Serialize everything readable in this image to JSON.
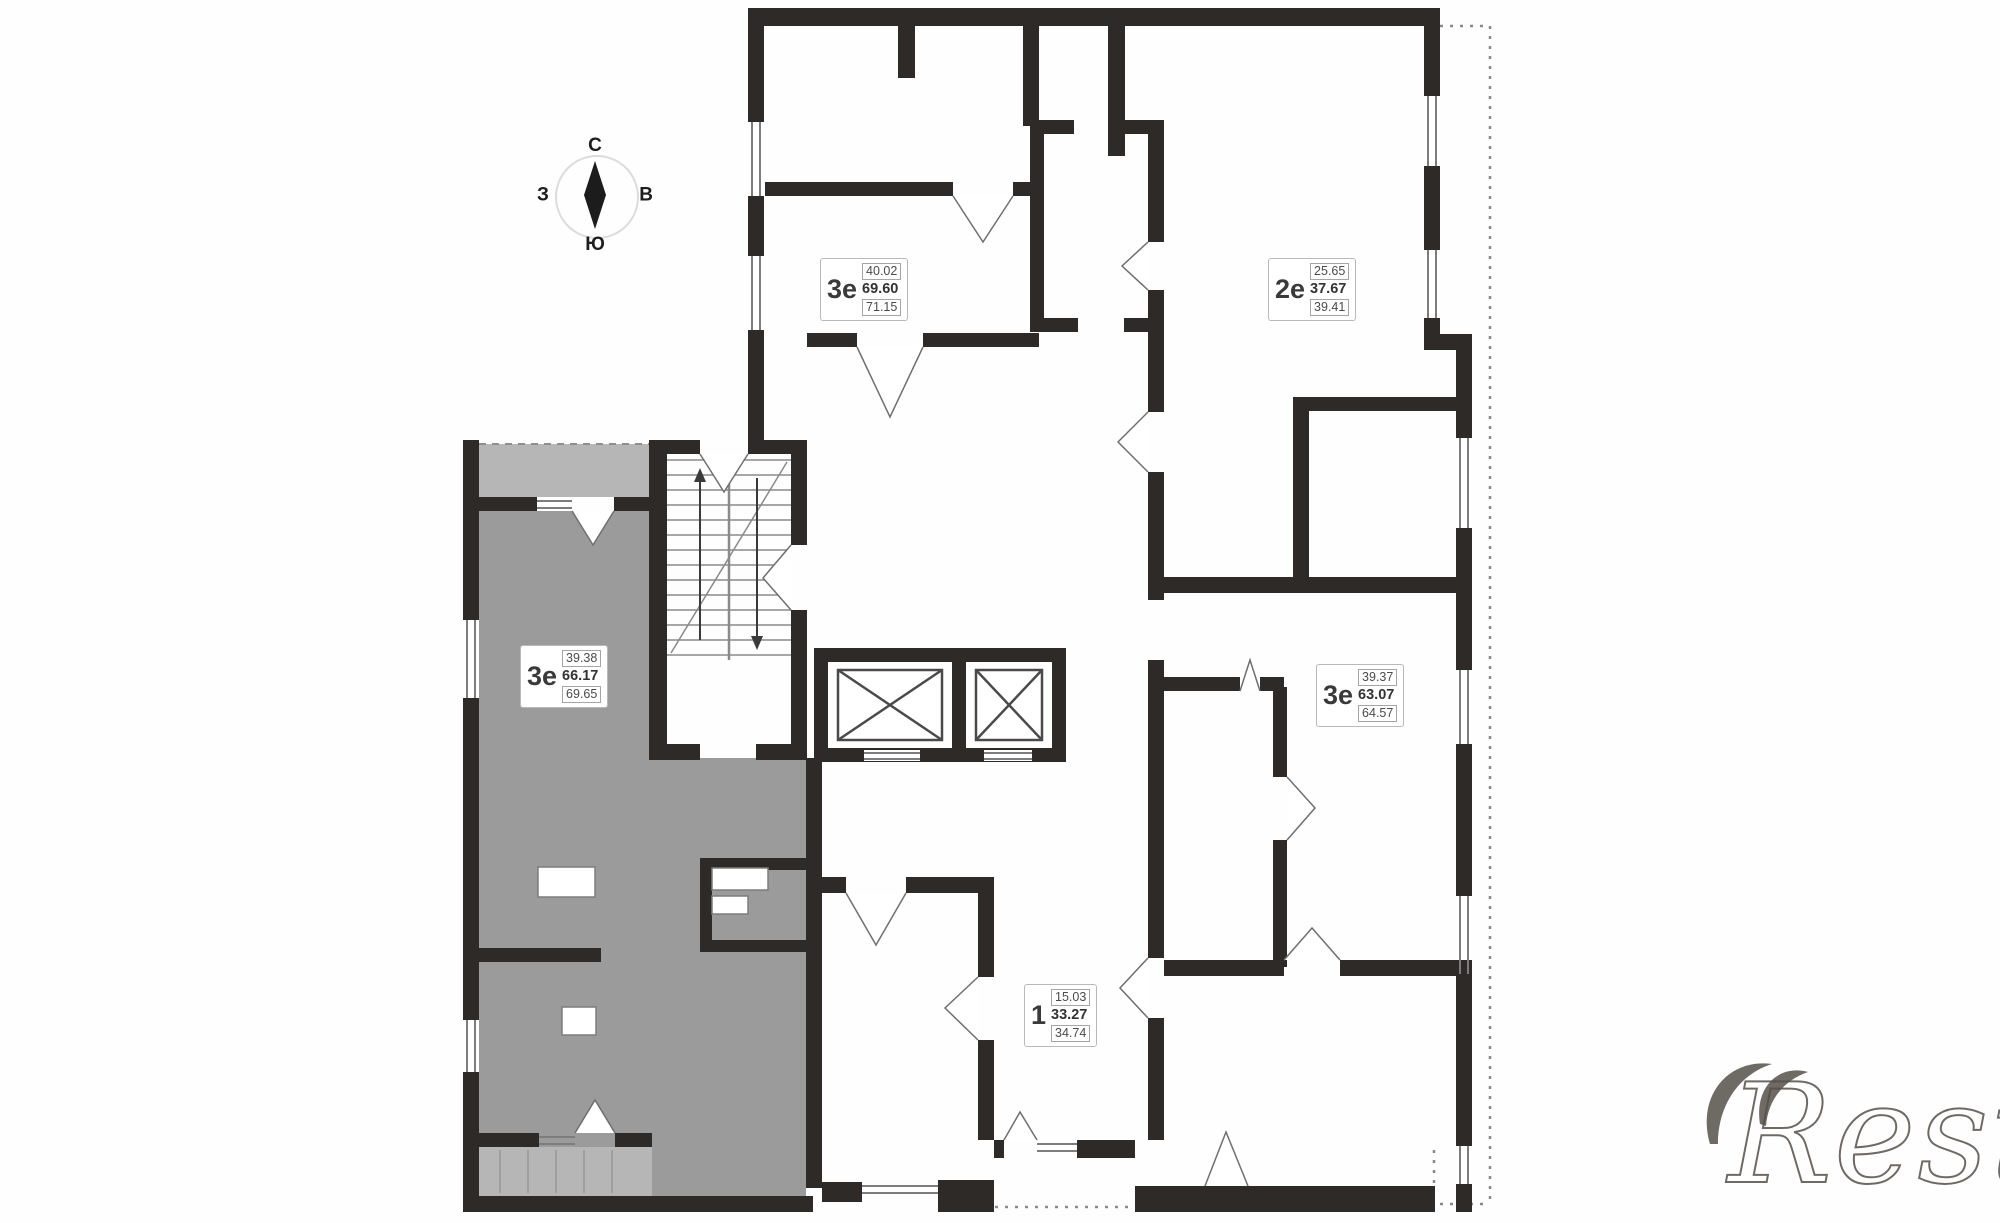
{
  "page": {
    "background": "#ffffff"
  },
  "colors": {
    "wall": "#2e2a27",
    "thin_line": "#7d7d7d",
    "highlight_fill": "#9b9b9b",
    "balcony_fill": "#b6b6b6",
    "compass_ring": "#dcdcdc",
    "watermark": "#555049"
  },
  "compass": {
    "north": "С",
    "south": "Ю",
    "west": "З",
    "east": "В"
  },
  "watermark": {
    "text": "Restate"
  },
  "apartments": [
    {
      "id": "top-left",
      "type": "3е",
      "area_living": "40.02",
      "area_total": "69.60",
      "area_total_balcony": "71.15",
      "highlighted": false
    },
    {
      "id": "top-right",
      "type": "2е",
      "area_living": "25.65",
      "area_total": "37.67",
      "area_total_balcony": "39.41",
      "highlighted": false
    },
    {
      "id": "left",
      "type": "3е",
      "area_living": "39.38",
      "area_total": "66.17",
      "area_total_balcony": "69.65",
      "highlighted": true
    },
    {
      "id": "right",
      "type": "3е",
      "area_living": "39.37",
      "area_total": "63.07",
      "area_total_balcony": "64.57",
      "highlighted": false
    },
    {
      "id": "bottom",
      "type": "1",
      "area_living": "15.03",
      "area_total": "33.27",
      "area_total_balcony": "34.74",
      "highlighted": false
    }
  ]
}
